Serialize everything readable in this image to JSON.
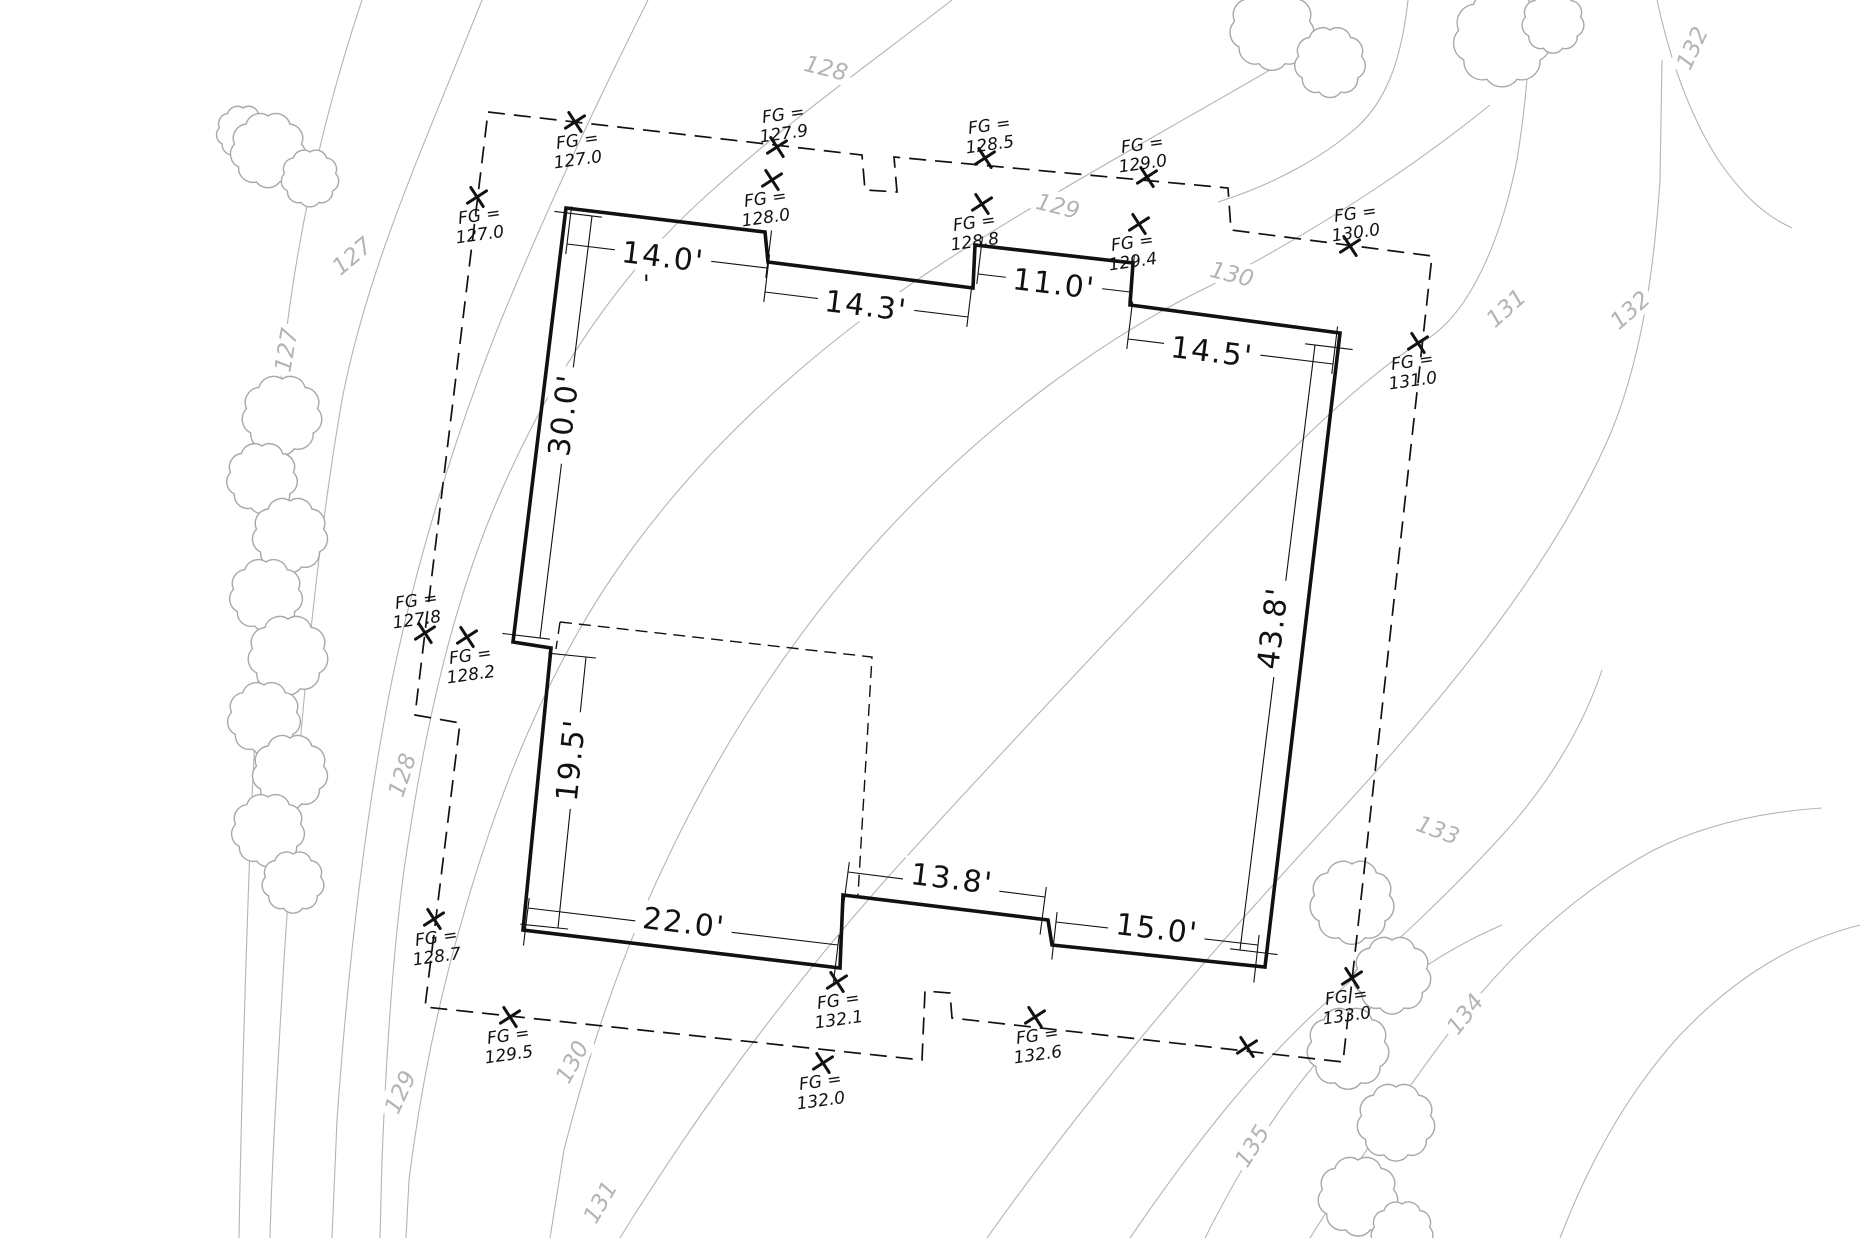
{
  "drawing": {
    "width": 1866,
    "height": 1238,
    "colors": {
      "ink": "#111111",
      "contour": "#b4b4b4",
      "tree": "#a8a8a8",
      "paper": "#ffffff"
    },
    "building": {
      "points": "566,208 765,232 768,262 973,288 975,245 1133,263 1130,305 1340,333 1265,967 1052,945 1048,920 843,895 840,968 523,930 551,648 513,642",
      "stroke_width": 3.6
    },
    "envelope": {
      "path": "M 488,112 L 862,155 L 865,190 L 897,192 L 894,157 L 1228,188 L 1231,230 L 1432,256 L 1343,1062 L 952,1018 L 950,993 L 925,991 L 922,1060 L 425,1007 L 460,723 L 415,715 Z",
      "dash": "17 9",
      "stroke_width": 1.7
    },
    "inner_dashed": {
      "path": "M 560,622 L 556,649 M 560,622 L 872,657 L 858,895",
      "dash": "12 7",
      "stroke_width": 1.4
    },
    "fg_prefix": "FG =",
    "fg_markers": [
      {
        "value": "127.0",
        "x": 575,
        "y": 122,
        "lx": 578,
        "ly": 146
      },
      {
        "value": "127.9",
        "x": 777,
        "y": 147,
        "lx": 784,
        "ly": 120
      },
      {
        "value": "128.5",
        "x": 985,
        "y": 158,
        "lx": 990,
        "ly": 131
      },
      {
        "value": "129.0",
        "x": 1147,
        "y": 177,
        "lx": 1143,
        "ly": 150
      },
      {
        "value": "130.0",
        "x": 1350,
        "y": 246,
        "lx": 1356,
        "ly": 219
      },
      {
        "value": "127.0",
        "x": 477,
        "y": 197,
        "lx": 480,
        "ly": 221
      },
      {
        "value": "128.0",
        "x": 772,
        "y": 180,
        "lx": 766,
        "ly": 204
      },
      {
        "value": "128.8",
        "x": 982,
        "y": 204,
        "lx": 975,
        "ly": 228
      },
      {
        "value": "129.4",
        "x": 1139,
        "y": 224,
        "lx": 1133,
        "ly": 248
      },
      {
        "value": "131.0",
        "x": 1418,
        "y": 343,
        "lx": 1413,
        "ly": 367
      },
      {
        "value": "127.8",
        "x": 425,
        "y": 633,
        "lx": 417,
        "ly": 606
      },
      {
        "value": "128.2",
        "x": 467,
        "y": 637,
        "lx": 471,
        "ly": 661
      },
      {
        "value": "128.7",
        "x": 434,
        "y": 919,
        "lx": 437,
        "ly": 943
      },
      {
        "value": "129.5",
        "x": 510,
        "y": 1017,
        "lx": 509,
        "ly": 1041
      },
      {
        "value": "132.1",
        "x": 837,
        "y": 982,
        "lx": 839,
        "ly": 1006
      },
      {
        "value": "132.0",
        "x": 823,
        "y": 1063,
        "lx": 821,
        "ly": 1087
      },
      {
        "value": "132.6",
        "x": 1035,
        "y": 1017,
        "lx": 1038,
        "ly": 1041
      },
      {
        "value": "133.0",
        "x": 1352,
        "y": 978,
        "lx": 1347,
        "ly": 1002
      },
      {
        "value": "",
        "x": 1247,
        "y": 1047,
        "lx": 0,
        "ly": 0
      }
    ],
    "dimensions": [
      {
        "label": "14.0'",
        "x1": 567,
        "y1": 244,
        "x2": 767,
        "y2": 268,
        "lx": 663,
        "ly": 256,
        "rot": 7,
        "px": 0.12,
        "py": -0.99
      },
      {
        "label": "14.3'",
        "x1": 765,
        "y1": 292,
        "x2": 968,
        "y2": 317,
        "lx": 866,
        "ly": 305,
        "rot": 7,
        "px": 0.12,
        "py": -0.99
      },
      {
        "label": "11.0'",
        "x1": 978,
        "y1": 274,
        "x2": 1130,
        "y2": 292,
        "lx": 1054,
        "ly": 283,
        "rot": 7,
        "px": 0.12,
        "py": -0.99
      },
      {
        "label": "14.5'",
        "x1": 1128,
        "y1": 339,
        "x2": 1333,
        "y2": 364,
        "lx": 1212,
        "ly": 351,
        "rot": 7,
        "px": 0.12,
        "py": -0.99
      },
      {
        "label": "43.8'",
        "x1": 1315,
        "y1": 345,
        "x2": 1240,
        "y2": 950,
        "lx": 1272,
        "ly": 628,
        "rot": -83,
        "px": 0.99,
        "py": 0.12
      },
      {
        "label": "30.0'",
        "x1": 592,
        "y1": 216,
        "x2": 540,
        "y2": 638,
        "lx": 563,
        "ly": 415,
        "rot": -83,
        "px": -0.99,
        "py": -0.12
      },
      {
        "label": "19.5'",
        "x1": 586,
        "y1": 657,
        "x2": 558,
        "y2": 928,
        "lx": 570,
        "ly": 760,
        "rot": -84,
        "px": -0.99,
        "py": -0.1
      },
      {
        "label": "22.0'",
        "x1": 528,
        "y1": 908,
        "x2": 838,
        "y2": 945,
        "lx": 684,
        "ly": 922,
        "rot": 7,
        "px": -0.12,
        "py": 0.99
      },
      {
        "label": "13.8'",
        "x1": 848,
        "y1": 872,
        "x2": 1045,
        "y2": 897,
        "lx": 952,
        "ly": 878,
        "rot": 7,
        "px": -0.13,
        "py": 0.99
      },
      {
        "label": "15.0'",
        "x1": 1056,
        "y1": 922,
        "x2": 1258,
        "y2": 945,
        "lx": 1157,
        "ly": 928,
        "rot": 7,
        "px": -0.11,
        "py": 0.99
      }
    ],
    "contours": {
      "stroke_width": 1.1,
      "paths": [
        "M 362,0 C 322,120 296,240 283,360 C 271,480 259,640 251,820 C 245,980 241,1120 239,1238",
        "M 482,0 C 422,150 367,270 342,400 C 314,560 297,760 284,960 C 277,1080 272,1160 270,1238",
        "M 648,0 C 588,120 542,220 497,330 C 452,445 417,560 392,680 C 364,820 347,980 337,1120 L 332,1238",
        "M 952,0 C 872,62 792,118 707,195 C 614,278 542,390 489,520 C 447,625 422,745 404,870 C 392,960 386,1060 382,1160 L 380,1238",
        "M 1318,42 C 1182,122 1062,186 944,262 C 824,340 709,440 624,560 C 549,665 499,790 462,920 C 436,1010 419,1100 409,1180 L 406,1238",
        "M 1408,0 C 1402,55 1388,100 1356,128 C 1322,158 1272,185 1218,202",
        "M 1490,105 C 1422,160 1332,222 1212,285 C 1107,335 992,420 897,520 C 802,620 722,740 662,870 C 617,965 587,1060 564,1150 L 550,1238",
        "M 620,1238 C 702,1105 802,970 917,845 C 1032,720 1162,580 1287,455 C 1347,395 1397,355 1422,342 C 1467,318 1500,245 1517,160 C 1526,105 1530,50 1532,0",
        "M 987,1238 C 1092,1090 1212,950 1332,820 C 1452,690 1557,560 1612,430 C 1642,355 1654,270 1660,180 L 1662,60",
        "M 1657,0 C 1670,60 1690,115 1717,158 C 1742,195 1764,215 1792,228",
        "M 1130,1238 C 1197,1140 1267,1050 1352,980 C 1400,940 1462,880 1507,830 C 1547,785 1582,730 1602,670",
        "M 1310,1238 C 1362,1155 1417,1072 1467,1010 C 1522,942 1582,890 1650,852 C 1702,825 1762,812 1822,808",
        "M 1205,1238 C 1237,1175 1272,1115 1317,1062 C 1372,1000 1432,955 1502,925",
        "M 1560,1238 C 1590,1160 1630,1090 1680,1035 C 1740,972 1800,940 1860,925"
      ],
      "labels": [
        {
          "text": "127",
          "x": 352,
          "y": 256,
          "rot": -40
        },
        {
          "text": "127",
          "x": 286,
          "y": 350,
          "rot": -80
        },
        {
          "text": "128",
          "x": 826,
          "y": 68,
          "rot": 14
        },
        {
          "text": "128",
          "x": 402,
          "y": 775,
          "rot": -72
        },
        {
          "text": "129",
          "x": 1058,
          "y": 206,
          "rot": 14
        },
        {
          "text": "129",
          "x": 400,
          "y": 1092,
          "rot": -65
        },
        {
          "text": "130",
          "x": 1232,
          "y": 274,
          "rot": 14
        },
        {
          "text": "130",
          "x": 572,
          "y": 1062,
          "rot": -62
        },
        {
          "text": "131",
          "x": 1506,
          "y": 308,
          "rot": -42
        },
        {
          "text": "131",
          "x": 600,
          "y": 1202,
          "rot": -60
        },
        {
          "text": "132",
          "x": 1630,
          "y": 310,
          "rot": -42
        },
        {
          "text": "132",
          "x": 1692,
          "y": 48,
          "rot": -65
        },
        {
          "text": "133",
          "x": 1438,
          "y": 830,
          "rot": 20
        },
        {
          "text": "134",
          "x": 1465,
          "y": 1014,
          "rot": -52
        },
        {
          "text": "135",
          "x": 1252,
          "y": 1146,
          "rot": -58
        }
      ]
    },
    "trees": [
      {
        "cx": 243,
        "cy": 132,
        "r": 24
      },
      {
        "cx": 268,
        "cy": 150,
        "r": 34
      },
      {
        "cx": 310,
        "cy": 178,
        "r": 26
      },
      {
        "cx": 282,
        "cy": 415,
        "r": 36
      },
      {
        "cx": 262,
        "cy": 478,
        "r": 32
      },
      {
        "cx": 290,
        "cy": 535,
        "r": 34
      },
      {
        "cx": 266,
        "cy": 595,
        "r": 33
      },
      {
        "cx": 288,
        "cy": 655,
        "r": 36
      },
      {
        "cx": 264,
        "cy": 718,
        "r": 33
      },
      {
        "cx": 290,
        "cy": 772,
        "r": 34
      },
      {
        "cx": 268,
        "cy": 830,
        "r": 33
      },
      {
        "cx": 293,
        "cy": 882,
        "r": 28
      },
      {
        "cx": 1272,
        "cy": 28,
        "r": 38
      },
      {
        "cx": 1330,
        "cy": 62,
        "r": 32
      },
      {
        "cx": 1502,
        "cy": 38,
        "r": 44
      },
      {
        "cx": 1553,
        "cy": 22,
        "r": 28
      },
      {
        "cx": 1352,
        "cy": 902,
        "r": 38
      },
      {
        "cx": 1392,
        "cy": 975,
        "r": 35
      },
      {
        "cx": 1348,
        "cy": 1048,
        "r": 37
      },
      {
        "cx": 1396,
        "cy": 1122,
        "r": 35
      },
      {
        "cx": 1358,
        "cy": 1196,
        "r": 36
      },
      {
        "cx": 1402,
        "cy": 1232,
        "r": 28
      }
    ],
    "stray_mark": {
      "text": "'",
      "x": 643,
      "y": 292
    }
  }
}
